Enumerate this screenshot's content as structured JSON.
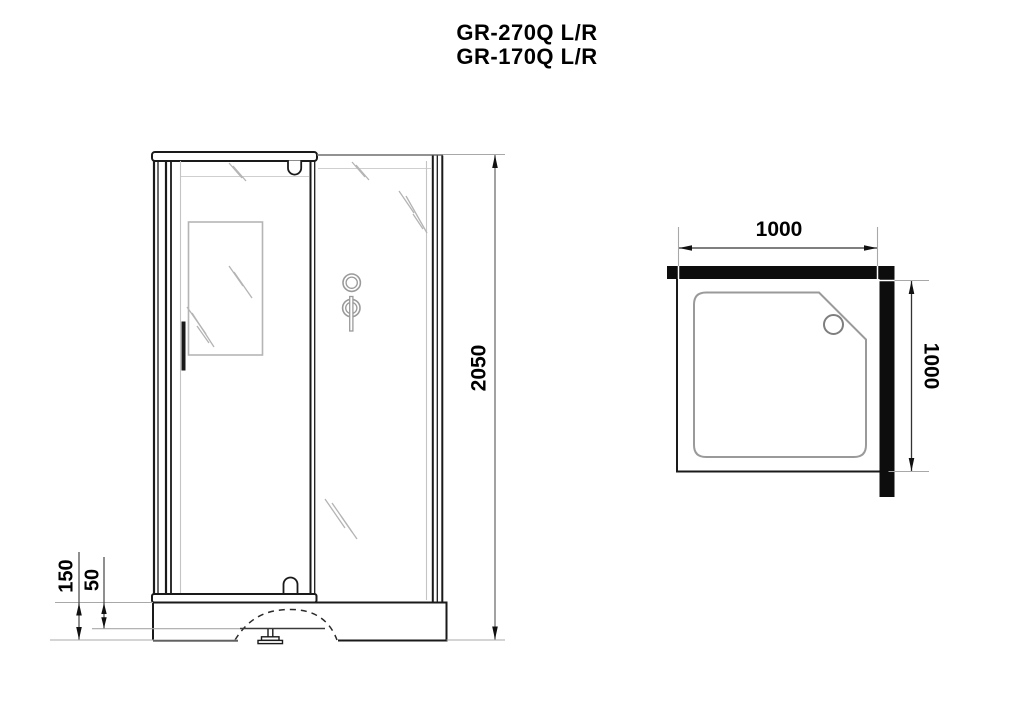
{
  "title": {
    "line1": "GR-270Q L/R",
    "line2": "GR-170Q L/R"
  },
  "front_view": {
    "dim_height": "2050",
    "dim_tray_height": "150",
    "dim_tray_step": "50"
  },
  "top_view": {
    "dim_width": "1000",
    "dim_depth": "1000"
  },
  "colors": {
    "main_line": "#1a1a1a",
    "light_line": "#b0b0b0",
    "dim_line": "#555555",
    "bar_fill": "#0d0d0d",
    "background": "#ffffff"
  }
}
